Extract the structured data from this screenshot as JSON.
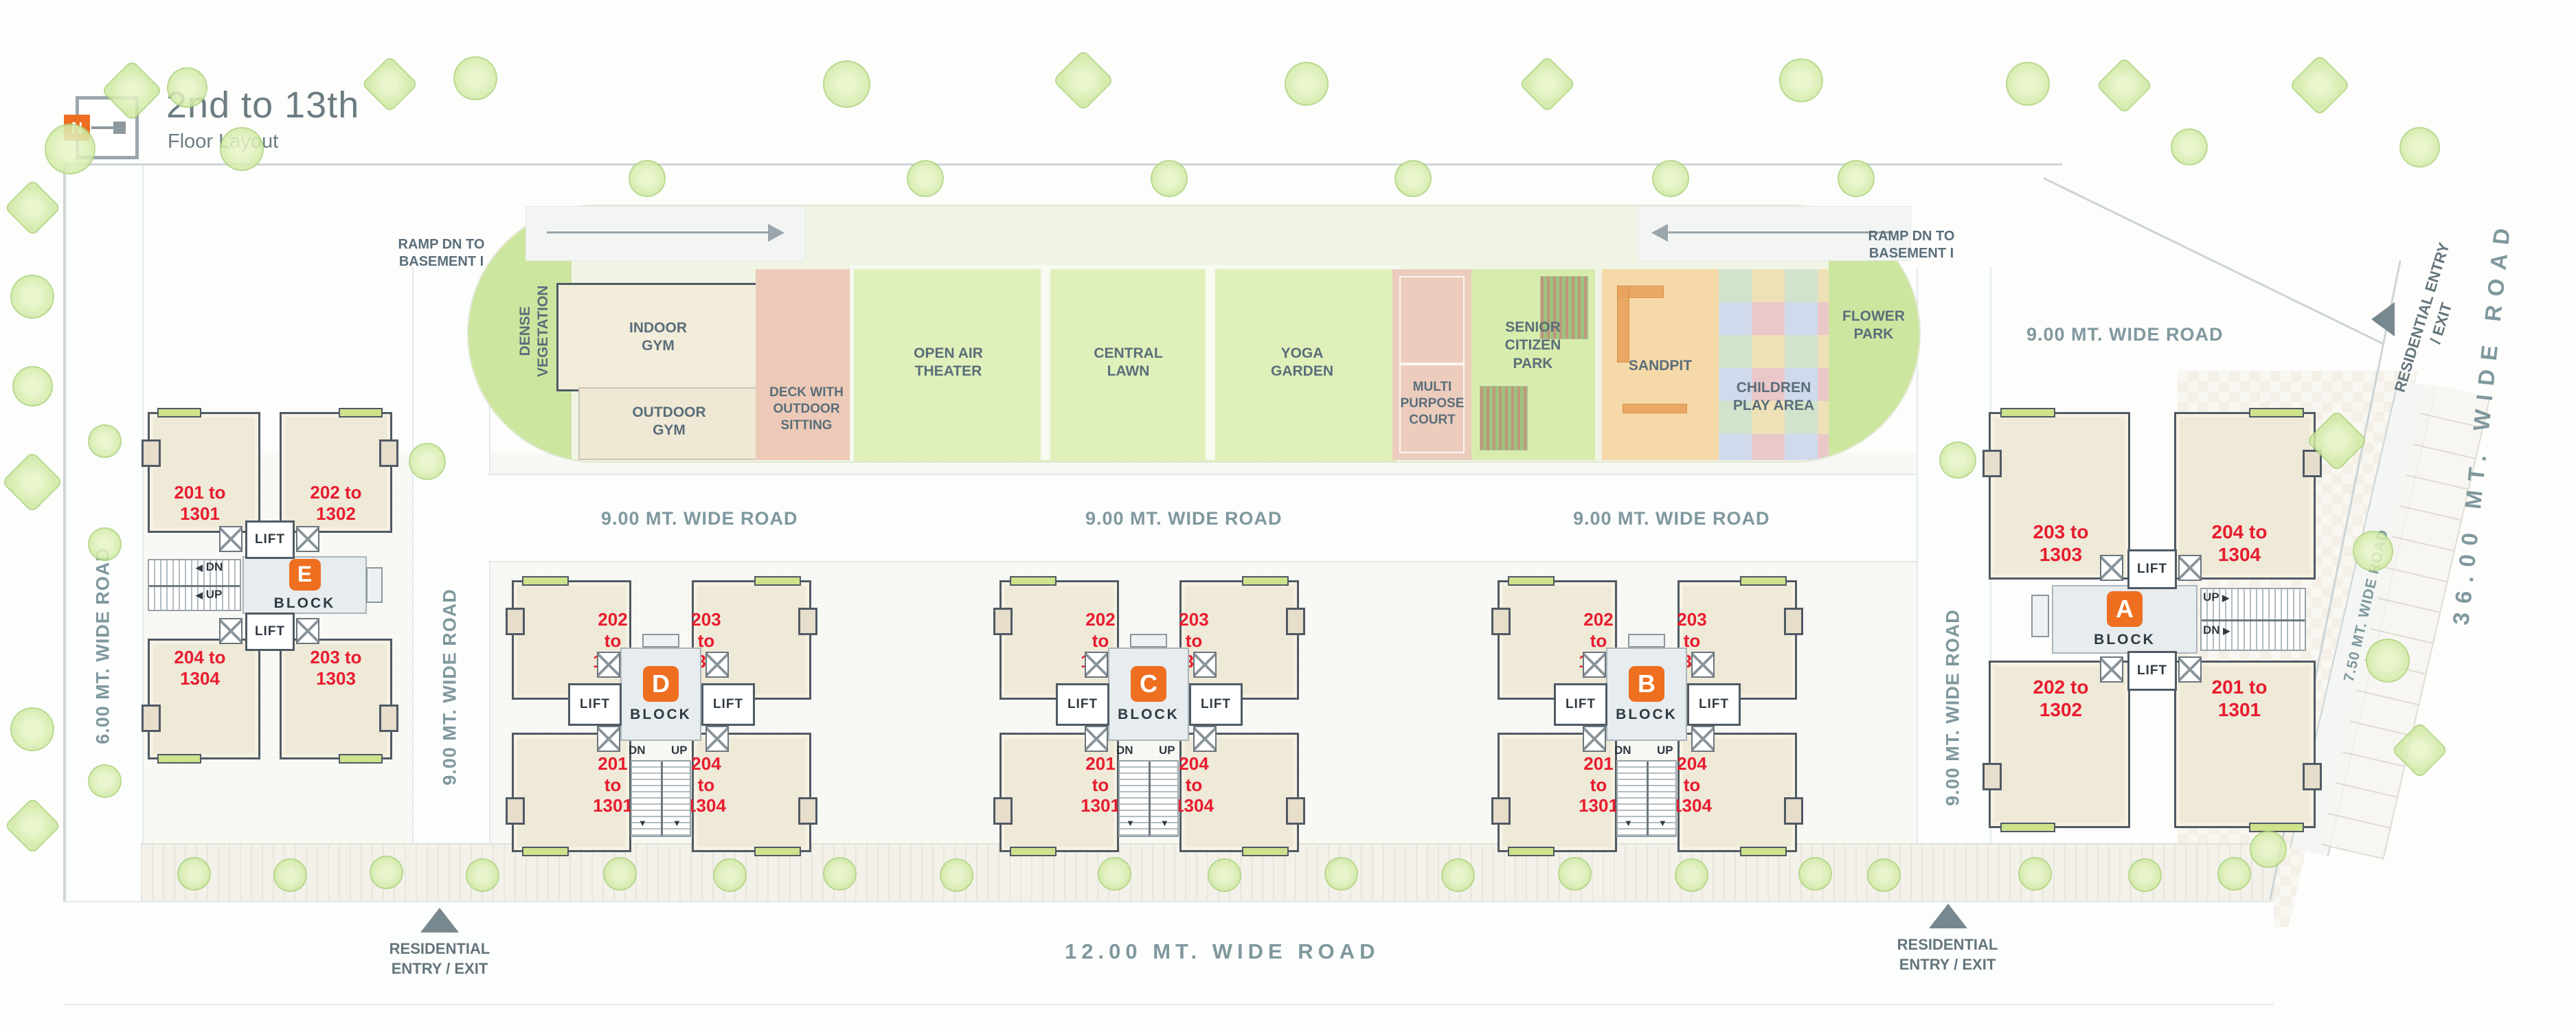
{
  "colors": {
    "accent_orange": "#ee6f20",
    "unit_red": "#e81c2e",
    "road_text": "#7f989e",
    "title_text": "#6b7c82",
    "wall_dark": "#4f5a64"
  },
  "title": {
    "main": "2nd to 13th",
    "sub": "Floor Layout",
    "north_letter": "N"
  },
  "icons": {
    "arrow_left": "◀",
    "arrow_right": "▶",
    "arrow_down": "▼"
  },
  "ramps": {
    "left": "RAMP DN TO BASEMENT I",
    "right": "RAMP DN TO BASEMENT I"
  },
  "amenities": {
    "dense_vegetation": "DENSE VEGETATION",
    "indoor_gym": "INDOOR GYM",
    "outdoor_gym": "OUTDOOR GYM",
    "deck": "DECK WITH OUTDOOR SITTING",
    "open_air_theater": "OPEN AIR THEATER",
    "central_lawn": "CENTRAL LAWN",
    "yoga_garden": "YOGA GARDEN",
    "multi_purpose_court": "MULTI PURPOSE COURT",
    "senior_citizen_park": "SENIOR CITIZEN PARK",
    "sandpit": "SANDPIT",
    "children_play_area": "CHILDREN PLAY AREA",
    "flower_park": "FLOWER PARK"
  },
  "roads": {
    "nine_a": "9.00 MT. WIDE ROAD",
    "nine_b": "9.00 MT. WIDE ROAD",
    "nine_c": "9.00 MT. WIDE ROAD",
    "nine_corner": "9.00 MT. WIDE ROAD",
    "six_left": "6.00 MT. WIDE ROAD",
    "nine_left_v": "9.00 MT. WIDE ROAD",
    "nine_right_v": "9.00 MT. WIDE ROAD",
    "seven_half": "7.50 MT. WIDE ROAD",
    "thirty_six": "36.00 MT. WIDE ROAD",
    "twelve": "12.00 MT. WIDE ROAD"
  },
  "entries": {
    "bottom_left": "RESIDENTIAL ENTRY / EXIT",
    "bottom_right": "RESIDENTIAL ENTRY / EXIT",
    "top_right": "RESIDENTIAL ENTRY / EXIT"
  },
  "blocks": [
    {
      "id": "E",
      "letter": "E",
      "word": "BLOCK",
      "lift": "LIFT",
      "dn": "DN",
      "up": "UP",
      "units": {
        "tl": "201 to 1301",
        "tr": "202 to 1302",
        "bl": "204 to 1304",
        "br": "203 to 1303"
      }
    },
    {
      "id": "D",
      "letter": "D",
      "word": "BLOCK",
      "lift": "LIFT",
      "dn": "DN",
      "up": "UP",
      "units": {
        "tl": "202 to 1302",
        "tr": "203 to 1303",
        "bl": "201 to 1301",
        "br": "204 to 1304"
      }
    },
    {
      "id": "C",
      "letter": "C",
      "word": "BLOCK",
      "lift": "LIFT",
      "dn": "DN",
      "up": "UP",
      "units": {
        "tl": "202 to 1302",
        "tr": "203 to 1303",
        "bl": "201 to 1301",
        "br": "204 to 1304"
      }
    },
    {
      "id": "B",
      "letter": "B",
      "word": "BLOCK",
      "lift": "LIFT",
      "dn": "DN",
      "up": "UP",
      "units": {
        "tl": "202 to 1302",
        "tr": "203 to 1303",
        "bl": "201 to 1301",
        "br": "204 to 1304"
      }
    },
    {
      "id": "A",
      "letter": "A",
      "word": "BLOCK",
      "lift": "LIFT",
      "dn": "DN",
      "up": "UP",
      "units": {
        "tl": "203 to 1303",
        "tr": "204 to 1304",
        "bl": "202 to 1302",
        "br": "201 to 1301"
      }
    }
  ]
}
